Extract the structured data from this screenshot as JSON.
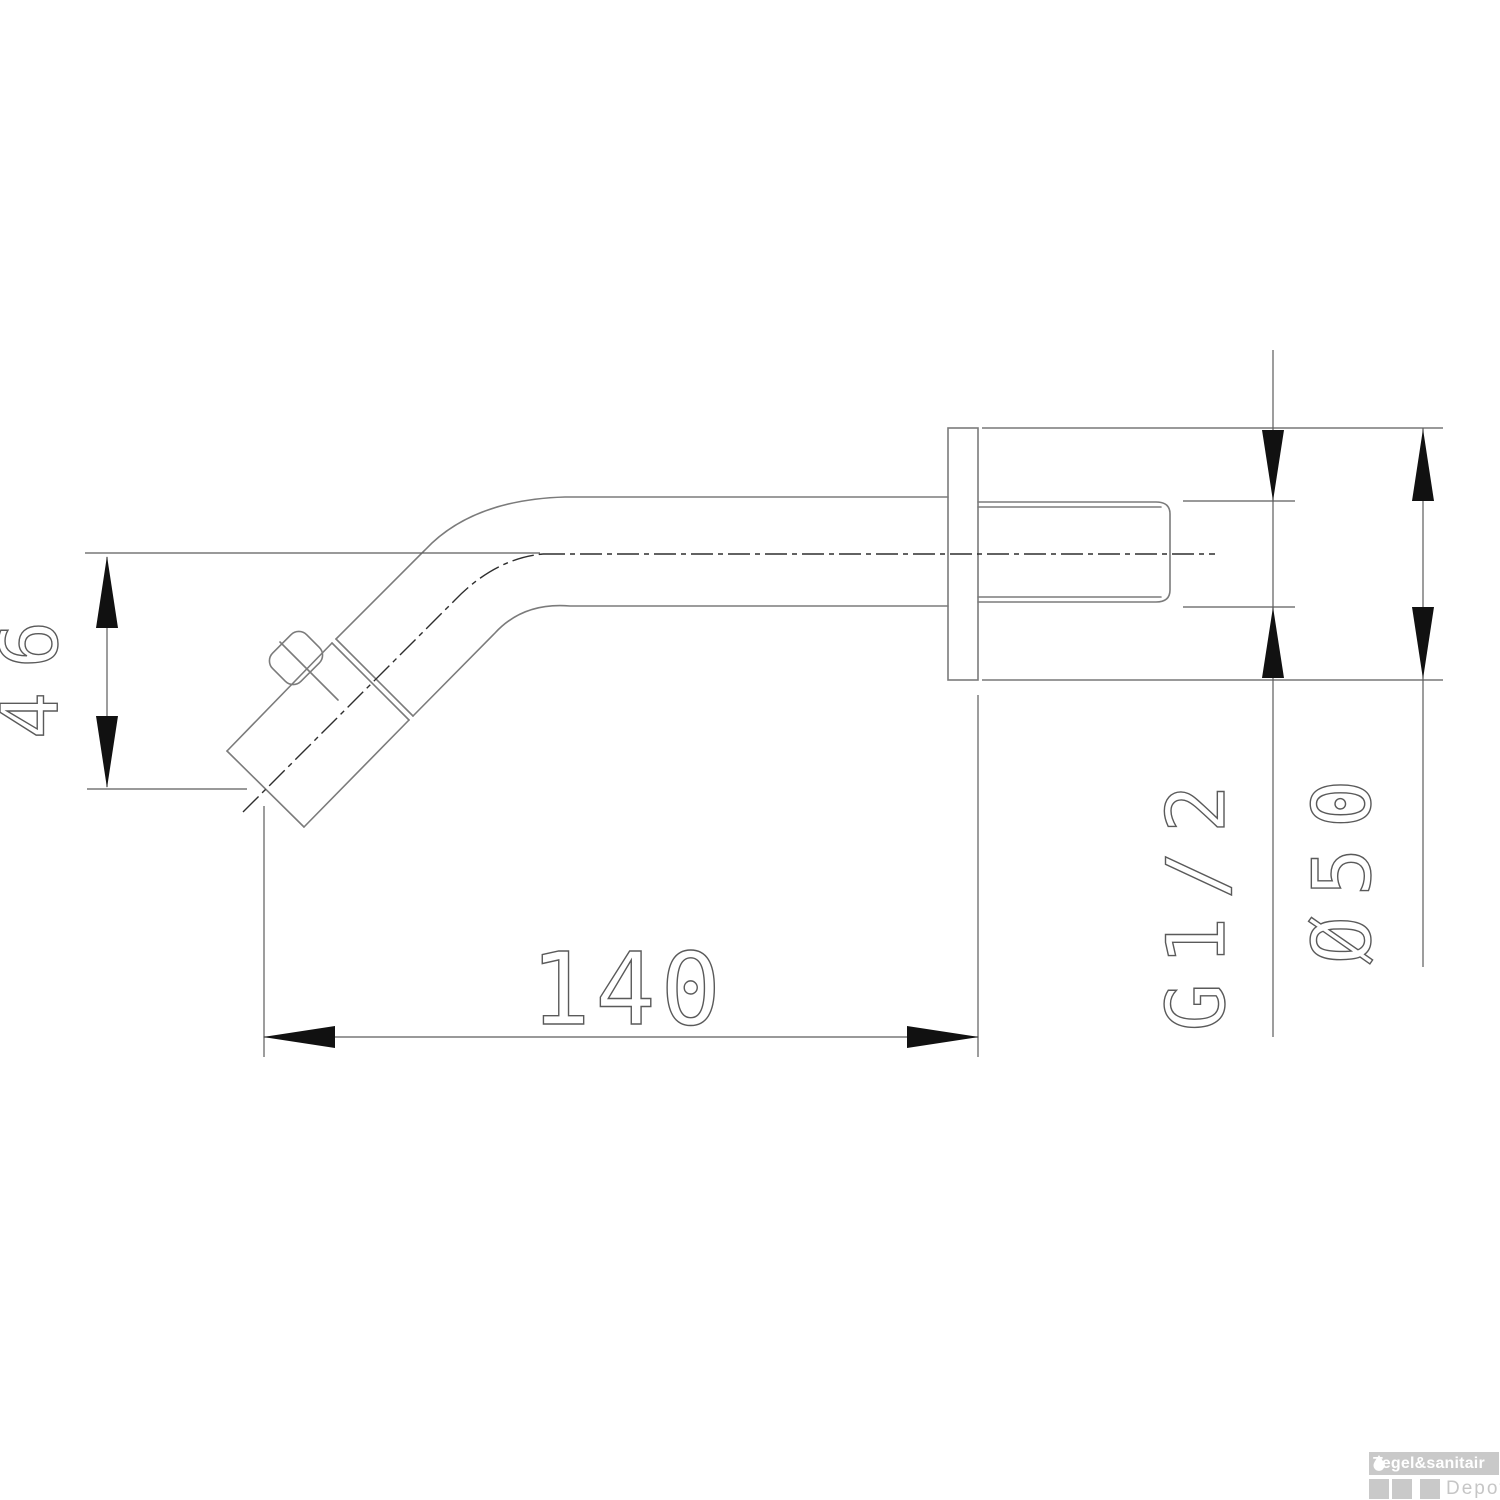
{
  "drawing": {
    "type": "technical-2d",
    "subject": "wall-mounted spout side view with mounting flange and threaded connection",
    "line_color": "#7b7b7b",
    "dimension_color": "#5c5c5c",
    "arrow_color": "#111111",
    "dimensions": [
      {
        "id": "drop-height",
        "label": "46",
        "orientation": "vertical-left"
      },
      {
        "id": "projection-length",
        "label": "140",
        "orientation": "horizontal-bottom"
      },
      {
        "id": "thread-size",
        "label": "G1/2",
        "orientation": "rotated-right"
      },
      {
        "id": "flange-diameter",
        "label": "Ø50",
        "orientation": "rotated-right"
      }
    ]
  },
  "watermark": {
    "brand": "Tegel&sanitair",
    "sub": "Depot",
    "bar_color": "#c9c9c9",
    "text_color": "#ffffff"
  }
}
